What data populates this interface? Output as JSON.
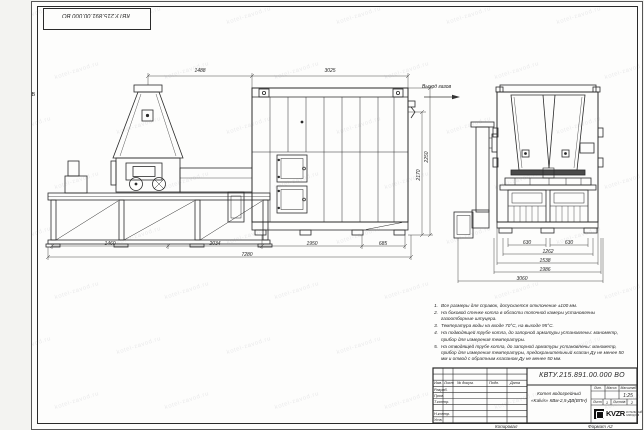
{
  "sheet": {
    "corner_stamp": "КВТУ.215.891.00.000 ВО",
    "zone_letter": "В"
  },
  "watermark": {
    "text": "kotel-zavod.ru"
  },
  "labels": {
    "gas_outlet": "Выход газов"
  },
  "dims": {
    "top_left": "1488",
    "top_right": "3025",
    "height_outer": "2250",
    "height_inner": "2170",
    "bottom": [
      "1460",
      "2034",
      "1950",
      "685"
    ],
    "bottom_total": "7280",
    "end_row1": [
      "630",
      "630"
    ],
    "end_row2": "1262",
    "end_row3": "1538",
    "end_row4": "1986",
    "end_total": "3060"
  },
  "notes": {
    "items": [
      {
        "n": "1.",
        "text": "Все размеры для справок, допускается отклонение ±100 мм."
      },
      {
        "n": "2.",
        "text": "На боковой стенке котла в области топочной камеры установлены газоотборные штуцера."
      },
      {
        "n": "3.",
        "text": "Температура воды на входе 70°С, на выходе 95°С."
      },
      {
        "n": "4.",
        "text": "На подводящей трубе котла, до запорной арматуры установлены: манометр, прибор для измерения температуры."
      },
      {
        "n": "5.",
        "text": "На отводящей трубе котла, до запорной арматуры установлены: манометр, прибор для измерения температуры, предохранительный клапан Ду не менее 50 мм и отвод с обратным клапаном Ду не менее 50 мм."
      }
    ]
  },
  "titleblock": {
    "designation": "КВТУ.215.891.00.000 ВО",
    "doc_name_line1": "Котел водогрейный",
    "doc_name_line2": "«Kalvis» КВм-2,5-ДВ(ВПН)",
    "header_cols": [
      "Изм.",
      "Лист",
      "№ докум.",
      "Подп.",
      "Дата"
    ],
    "roles": [
      "Разраб.",
      "Пров.",
      "Т.контр.",
      "Н.контр.",
      "Утв."
    ],
    "lit_label": "Лит.",
    "mass_label": "Масса",
    "scale_label": "Масштаб",
    "scale_value": "1:25",
    "sheet_label": "Лист",
    "sheet_value": "1",
    "sheets_label": "Листов",
    "sheets_value": "2",
    "logo_text": "KVZR",
    "logo_caption1": "КОТЕЛЬНЫЙ",
    "logo_caption2": "ЗАВОД РФ",
    "copy_label": "Копировал",
    "format_label": "Формат А2"
  }
}
